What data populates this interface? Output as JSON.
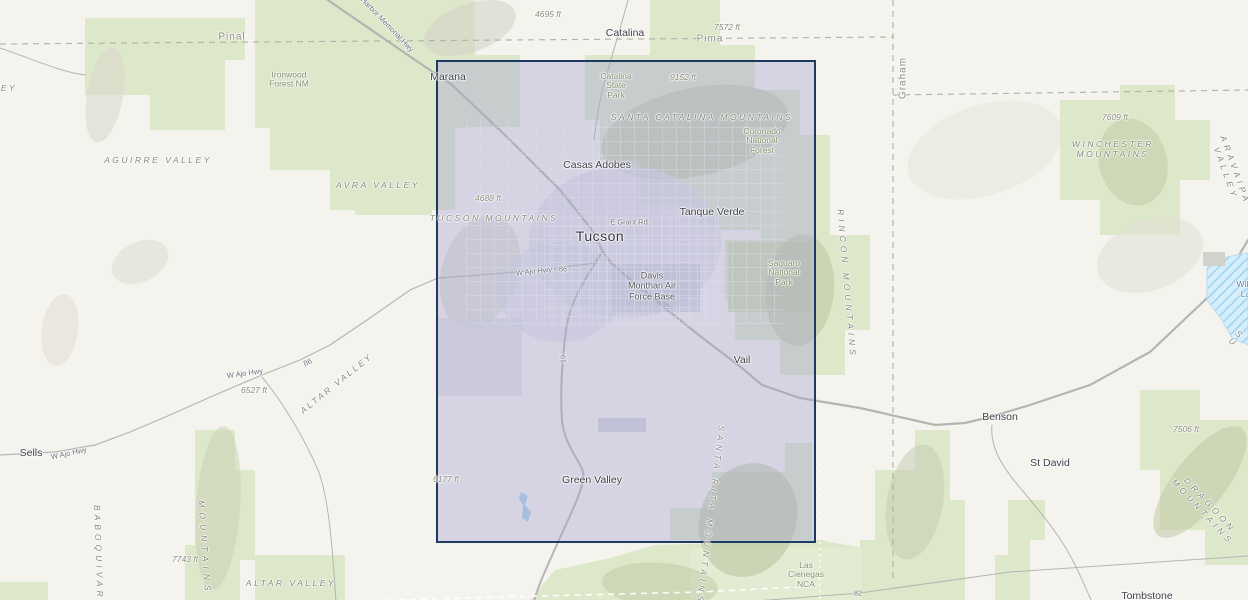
{
  "map": {
    "description": "Topographic basemap of the Tucson, Arizona region with a rectangular selection extent drawn over the Tucson metropolitan area",
    "colors": {
      "land": "#f5f3ee",
      "public_land_green": "#dde7ca",
      "forest_green": "#cfdcb2",
      "selection_border": "#1d3a63",
      "selection_fill": "rgba(164,164,209,0.38)",
      "water_fill": "#cfe9f7",
      "road_gray": "#b5b5b0",
      "boundary_dash_gray": "#b4b4ac",
      "boundary_dash_white": "#ffffff"
    },
    "selection": {
      "name": "selection-rectangle"
    },
    "labels": [
      {
        "name": "county-pinal",
        "cls": "county",
        "text": "Pinal",
        "x": 232,
        "y": 37
      },
      {
        "name": "county-pima",
        "cls": "county",
        "text": "Pima",
        "x": 710,
        "y": 39
      },
      {
        "name": "county-graham",
        "cls": "county",
        "text": "Graham",
        "x": 903,
        "y": 78,
        "rot": -90
      },
      {
        "name": "city-catalina",
        "cls": "city",
        "text": "Catalina",
        "x": 625,
        "y": 33
      },
      {
        "name": "city-marana",
        "cls": "city",
        "text": "Marana",
        "x": 448,
        "y": 77
      },
      {
        "name": "city-casas-adobes",
        "cls": "city",
        "text": "Casas Adobes",
        "x": 597,
        "y": 165
      },
      {
        "name": "city-tanque-verde",
        "cls": "city",
        "text": "Tanque Verde",
        "x": 712,
        "y": 212
      },
      {
        "name": "city-tucson",
        "cls": "city-lg",
        "text": "Tucson",
        "x": 600,
        "y": 236
      },
      {
        "name": "city-vail",
        "cls": "city",
        "text": "Vail",
        "x": 742,
        "y": 360
      },
      {
        "name": "city-green-valley",
        "cls": "city",
        "text": "Green Valley",
        "x": 592,
        "y": 480
      },
      {
        "name": "city-sells",
        "cls": "city",
        "text": "Sells",
        "x": 31,
        "y": 453
      },
      {
        "name": "city-benson",
        "cls": "city",
        "text": "Benson",
        "x": 1000,
        "y": 417
      },
      {
        "name": "city-st-david",
        "cls": "city",
        "text": "St David",
        "x": 1050,
        "y": 463
      },
      {
        "name": "city-tombstone",
        "cls": "city",
        "text": "Tombstone",
        "x": 1147,
        "y": 596
      },
      {
        "name": "place-davis-monthan-afb",
        "cls": "place2",
        "text": "Davis\nMonthan Air\nForce Base",
        "x": 652,
        "y": 286
      },
      {
        "name": "elev-4695ft",
        "cls": "elev",
        "text": "4695 ft",
        "x": 548,
        "y": 15
      },
      {
        "name": "elev-7572ft",
        "cls": "elev",
        "text": "7572 ft",
        "x": 727,
        "y": 28
      },
      {
        "name": "elev-9152ft",
        "cls": "elev",
        "text": "9152 ft",
        "x": 683,
        "y": 78
      },
      {
        "name": "elev-4688ft",
        "cls": "elev",
        "text": "4688 ft",
        "x": 488,
        "y": 199
      },
      {
        "name": "elev-7609ft",
        "cls": "elev",
        "text": "7609 ft",
        "x": 1115,
        "y": 118
      },
      {
        "name": "elev-6527ft",
        "cls": "elev",
        "text": "6527 ft",
        "x": 254,
        "y": 391
      },
      {
        "name": "elev-7506ft",
        "cls": "elev",
        "text": "7506 ft",
        "x": 1186,
        "y": 430
      },
      {
        "name": "elev-7743ft",
        "cls": "elev",
        "text": "7743 ft",
        "x": 185,
        "y": 560
      },
      {
        "name": "elev-6177ft",
        "cls": "elev",
        "text": "6177 ft",
        "x": 446,
        "y": 480
      },
      {
        "name": "range-aguirre-valley",
        "cls": "range",
        "text": "AGUIRRE VALLEY",
        "x": 158,
        "y": 161
      },
      {
        "name": "range-avra-valley",
        "cls": "range",
        "text": "AVRA VALLEY",
        "x": 378,
        "y": 186
      },
      {
        "name": "range-tucson-mountains",
        "cls": "range",
        "text": "TUCSON MOUNTAINS",
        "x": 494,
        "y": 219
      },
      {
        "name": "range-santa-catalina-mountains",
        "cls": "range",
        "text": "SANTA CATALINA MOUNTAINS",
        "x": 702,
        "y": 118
      },
      {
        "name": "range-winchester-mountains",
        "cls": "range",
        "text": "WINCHESTER\nMOUNTAINS",
        "x": 1113,
        "y": 150
      },
      {
        "name": "range-altar-valley-upper",
        "cls": "range",
        "text": "ALTAR VALLEY",
        "x": 337,
        "y": 384,
        "rot": -39
      },
      {
        "name": "range-altar-valley-lower",
        "cls": "range",
        "text": "ALTAR VALLEY",
        "x": 291,
        "y": 584
      },
      {
        "name": "range-baboquivari",
        "cls": "range ls4",
        "text": "BABOQUIVARI",
        "x": 98,
        "y": 556,
        "rot": 88
      },
      {
        "name": "range-baboquivari-mountains",
        "cls": "range ls5",
        "text": "MOUNTAINS",
        "x": 204,
        "y": 548,
        "rot": 86
      },
      {
        "name": "range-rincon-mountains",
        "cls": "range ls4",
        "text": "RINCON MOUNTAINS",
        "x": 846,
        "y": 284,
        "rot": 85
      },
      {
        "name": "range-santa-rita-mountains",
        "cls": "range ls4",
        "text": "SANTA RITA MOUNTAINS",
        "x": 710,
        "y": 515,
        "rot": 97
      },
      {
        "name": "range-dragoon-mountains",
        "cls": "range ls4",
        "text": "DRAGOON MOUNTAINS",
        "x": 1206,
        "y": 509,
        "rot": 47
      },
      {
        "name": "range-aravaipa-valley",
        "cls": "range ls4",
        "text": "ARAVAIPA VALLEY",
        "x": 1230,
        "y": 172,
        "rot": 70
      },
      {
        "name": "range-sulphur-clipped",
        "cls": "range",
        "text": "S U",
        "x": 1236,
        "y": 339,
        "rot": 40
      },
      {
        "name": "range-clipped-ey",
        "cls": "range",
        "text": "EY",
        "x": 9,
        "y": 89
      },
      {
        "name": "park-ironwood-forest-nm",
        "cls": "park",
        "text": "Ironwood\nForest NM",
        "x": 289,
        "y": 80
      },
      {
        "name": "park-catalina-state-park",
        "cls": "park",
        "text": "Catalina\nState\nPark",
        "x": 616,
        "y": 86
      },
      {
        "name": "park-coronado-national-forest",
        "cls": "park",
        "text": "Coronado\nNational\nForest",
        "x": 762,
        "y": 141
      },
      {
        "name": "park-saguaro-national-park",
        "cls": "park",
        "text": "Saguaro\nNational\nPark",
        "x": 784,
        "y": 273
      },
      {
        "name": "park-las-cienegas-nca",
        "cls": "park",
        "text": "Las\nCienegas\nNCA",
        "x": 806,
        "y": 575
      },
      {
        "name": "road-pearl-harbor-memorial-hwy",
        "cls": "road",
        "text": "Pearl Harbor Memorial Hwy",
        "x": 380,
        "y": 18,
        "rot": 46
      },
      {
        "name": "road-e-grant-rd",
        "cls": "road",
        "text": "E Grant Rd",
        "x": 629,
        "y": 223
      },
      {
        "name": "road-w-ajo-hwy-1",
        "cls": "road",
        "text": "W Ajo Hwy",
        "x": 534,
        "y": 272,
        "rot": -6
      },
      {
        "name": "road-86-1",
        "cls": "road",
        "text": "86",
        "x": 563,
        "y": 270
      },
      {
        "name": "road-w-ajo-hwy-2",
        "cls": "road",
        "text": "W Ajo Hwy",
        "x": 245,
        "y": 374,
        "rot": -8
      },
      {
        "name": "road-86-2",
        "cls": "road",
        "text": "86",
        "x": 308,
        "y": 363,
        "rot": -25
      },
      {
        "name": "road-w-ajo-hwy-3",
        "cls": "road",
        "text": "W Ajo Hwy",
        "x": 69,
        "y": 454,
        "rot": -12
      },
      {
        "name": "road-19",
        "cls": "road",
        "text": "19",
        "x": 564,
        "y": 359,
        "rot": -90
      },
      {
        "name": "road-82",
        "cls": "road",
        "text": "82",
        "x": 858,
        "y": 594
      },
      {
        "name": "water-willcox-lake",
        "cls": "water",
        "text": "Willcox\nLake",
        "x": 1250,
        "y": 290
      }
    ]
  }
}
